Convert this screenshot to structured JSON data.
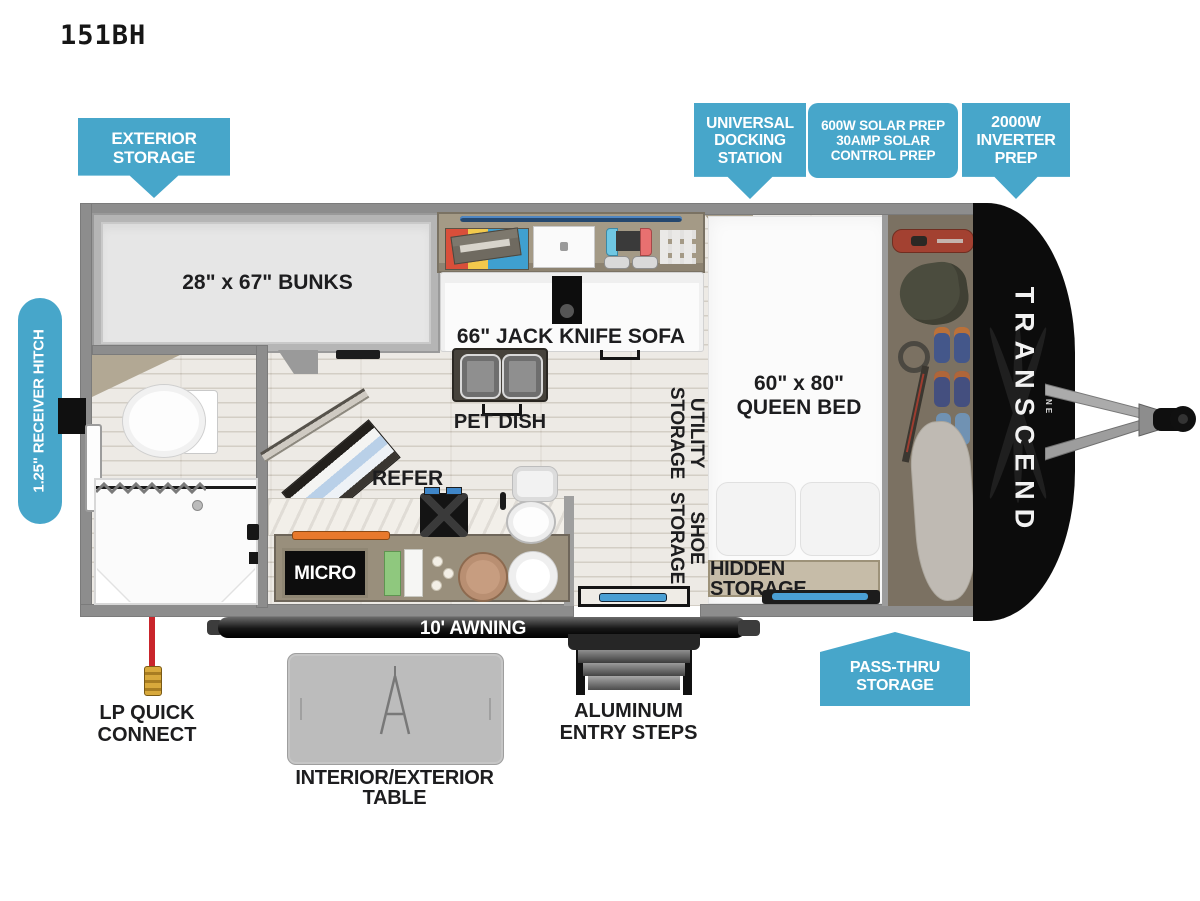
{
  "title": "151BH",
  "callouts": {
    "exterior_storage": "EXTERIOR\nSTORAGE",
    "universal_docking_station": "UNIVERSAL\nDOCKING\nSTATION",
    "solar_prep": "600W SOLAR PREP\n30AMP SOLAR\nCONTROL PREP",
    "inverter_prep": "2000W\nINVERTER\nPREP",
    "pass_thru_storage": "PASS-THRU\nSTORAGE",
    "receiver_hitch": "1.25\" RECEIVER HITCH"
  },
  "plan_labels": {
    "bunks": "28\" x 67\" BUNKS",
    "jack_knife_sofa": "66\" JACK KNIFE SOFA",
    "pet_dish": "PET DISH",
    "utility_storage": "UTILITY\nSTORAGE",
    "shoe_storage": "SHOE\nSTORAGE",
    "queen_bed": "60\" x 80\"\nQUEEN BED",
    "hidden_storage": "HIDDEN STORAGE",
    "refer": "REFER",
    "micro": "MICRO",
    "awning": "10' AWNING",
    "lp_quick_connect": "LP QUICK\nCONNECT",
    "aluminum_entry_steps": "ALUMINUM\nENTRY STEPS",
    "interior_exterior_table": "INTERIOR/EXTERIOR TABLE"
  },
  "brand": {
    "name": "TRANSCEND",
    "series": "ONE"
  },
  "colors": {
    "callout_blue": "#47a6ca",
    "label_ink": "#1d1d1f",
    "wall_gray": "#8d8d8d",
    "accent_blue": "#4a9fd4",
    "lp_red": "#c9252b"
  }
}
